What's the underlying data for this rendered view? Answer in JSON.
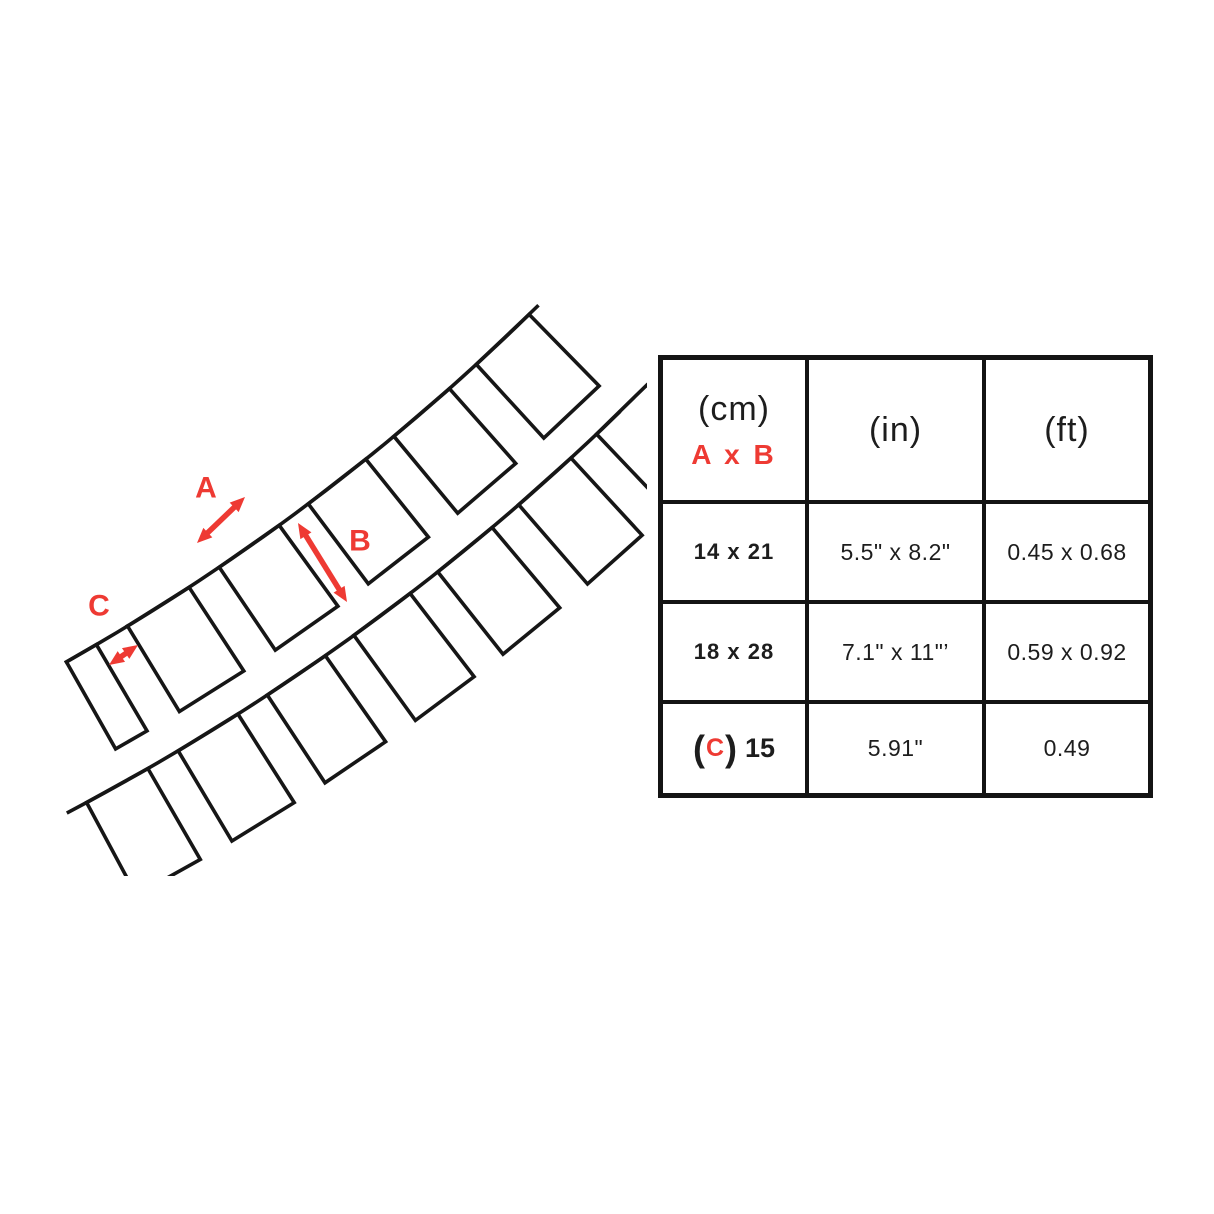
{
  "colors": {
    "accent": "#ee3a33",
    "ink": "#161616"
  },
  "diagram": {
    "label_a": "A",
    "label_b": "B",
    "label_c": "C"
  },
  "table": {
    "header": {
      "col1_unit": "(cm)",
      "col1_sub": "A x B",
      "col2": "(in)",
      "col3": "(ft)"
    },
    "rows": [
      {
        "cm": "14 x 21",
        "inch": "5.5\" x 8.2\"",
        "ft": "0.45 x 0.68"
      },
      {
        "cm": "18 x 28",
        "inch": "7.1\" x 11\"’",
        "ft": "0.59 x 0.92"
      },
      {
        "cm_open": "(",
        "cm_c": "C",
        "cm_close": ")",
        "cm_value": "15",
        "inch": "5.91\"",
        "ft": "0.49"
      }
    ]
  }
}
